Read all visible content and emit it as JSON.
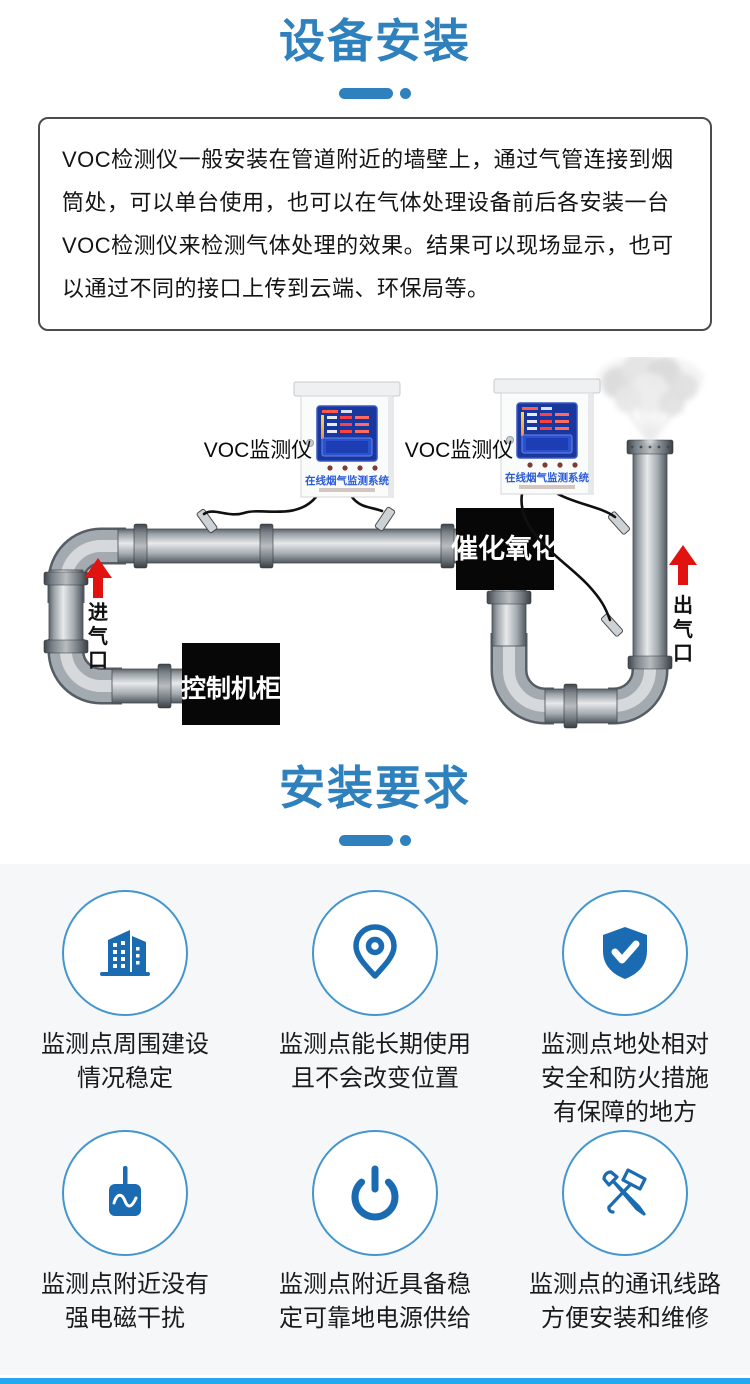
{
  "sections": {
    "install_title": "设备安装",
    "require_title": "安装要求"
  },
  "intro": {
    "text": "VOC检测仪一般安装在管道附近的墙壁上，通过气管连接到烟筒处，可以单台使用，也可以在气体处理设备前后各安装一台VOC检测仪来检测气体处理的效果。结果可以现场显示，也可以通过不同的接口上传到云端、环保局等。"
  },
  "diagram": {
    "monitor1_label": "VOC监测仪",
    "monitor2_label": "VOC监测仪",
    "device_title": "在线烟气监测系统",
    "catalytic_label": "催化氧化",
    "control_label": "控制机柜",
    "inlet_chars": [
      "进",
      "气",
      "口"
    ],
    "outlet_chars": [
      "出",
      "气",
      "口"
    ]
  },
  "requirements": [
    {
      "icon": "building-icon",
      "lines": [
        "监测点周围建设",
        "情况稳定",
        ""
      ]
    },
    {
      "icon": "location-pin-icon",
      "lines": [
        "监测点能长期使用",
        "且不会改变位置",
        ""
      ]
    },
    {
      "icon": "shield-check-icon",
      "lines": [
        "监测点地处相对",
        "安全和防火措施",
        "有保障的地方"
      ]
    },
    {
      "icon": "emi-monitor-icon",
      "lines": [
        "监测点附近没有",
        "强电磁干扰",
        ""
      ]
    },
    {
      "icon": "power-button-icon",
      "lines": [
        "监测点附近具备稳",
        "定可靠地电源供给",
        ""
      ]
    },
    {
      "icon": "repair-tools-icon",
      "lines": [
        "监测点的通讯线路",
        "方便安装和维修",
        ""
      ]
    }
  ],
  "colors": {
    "accent_blue": "#2e81bd",
    "icon_blue": "#1a6bb2",
    "arrow_red": "#e11310",
    "bottom_bar_blue": "#28a7f0",
    "panel_bg": "#f6f7f8"
  }
}
